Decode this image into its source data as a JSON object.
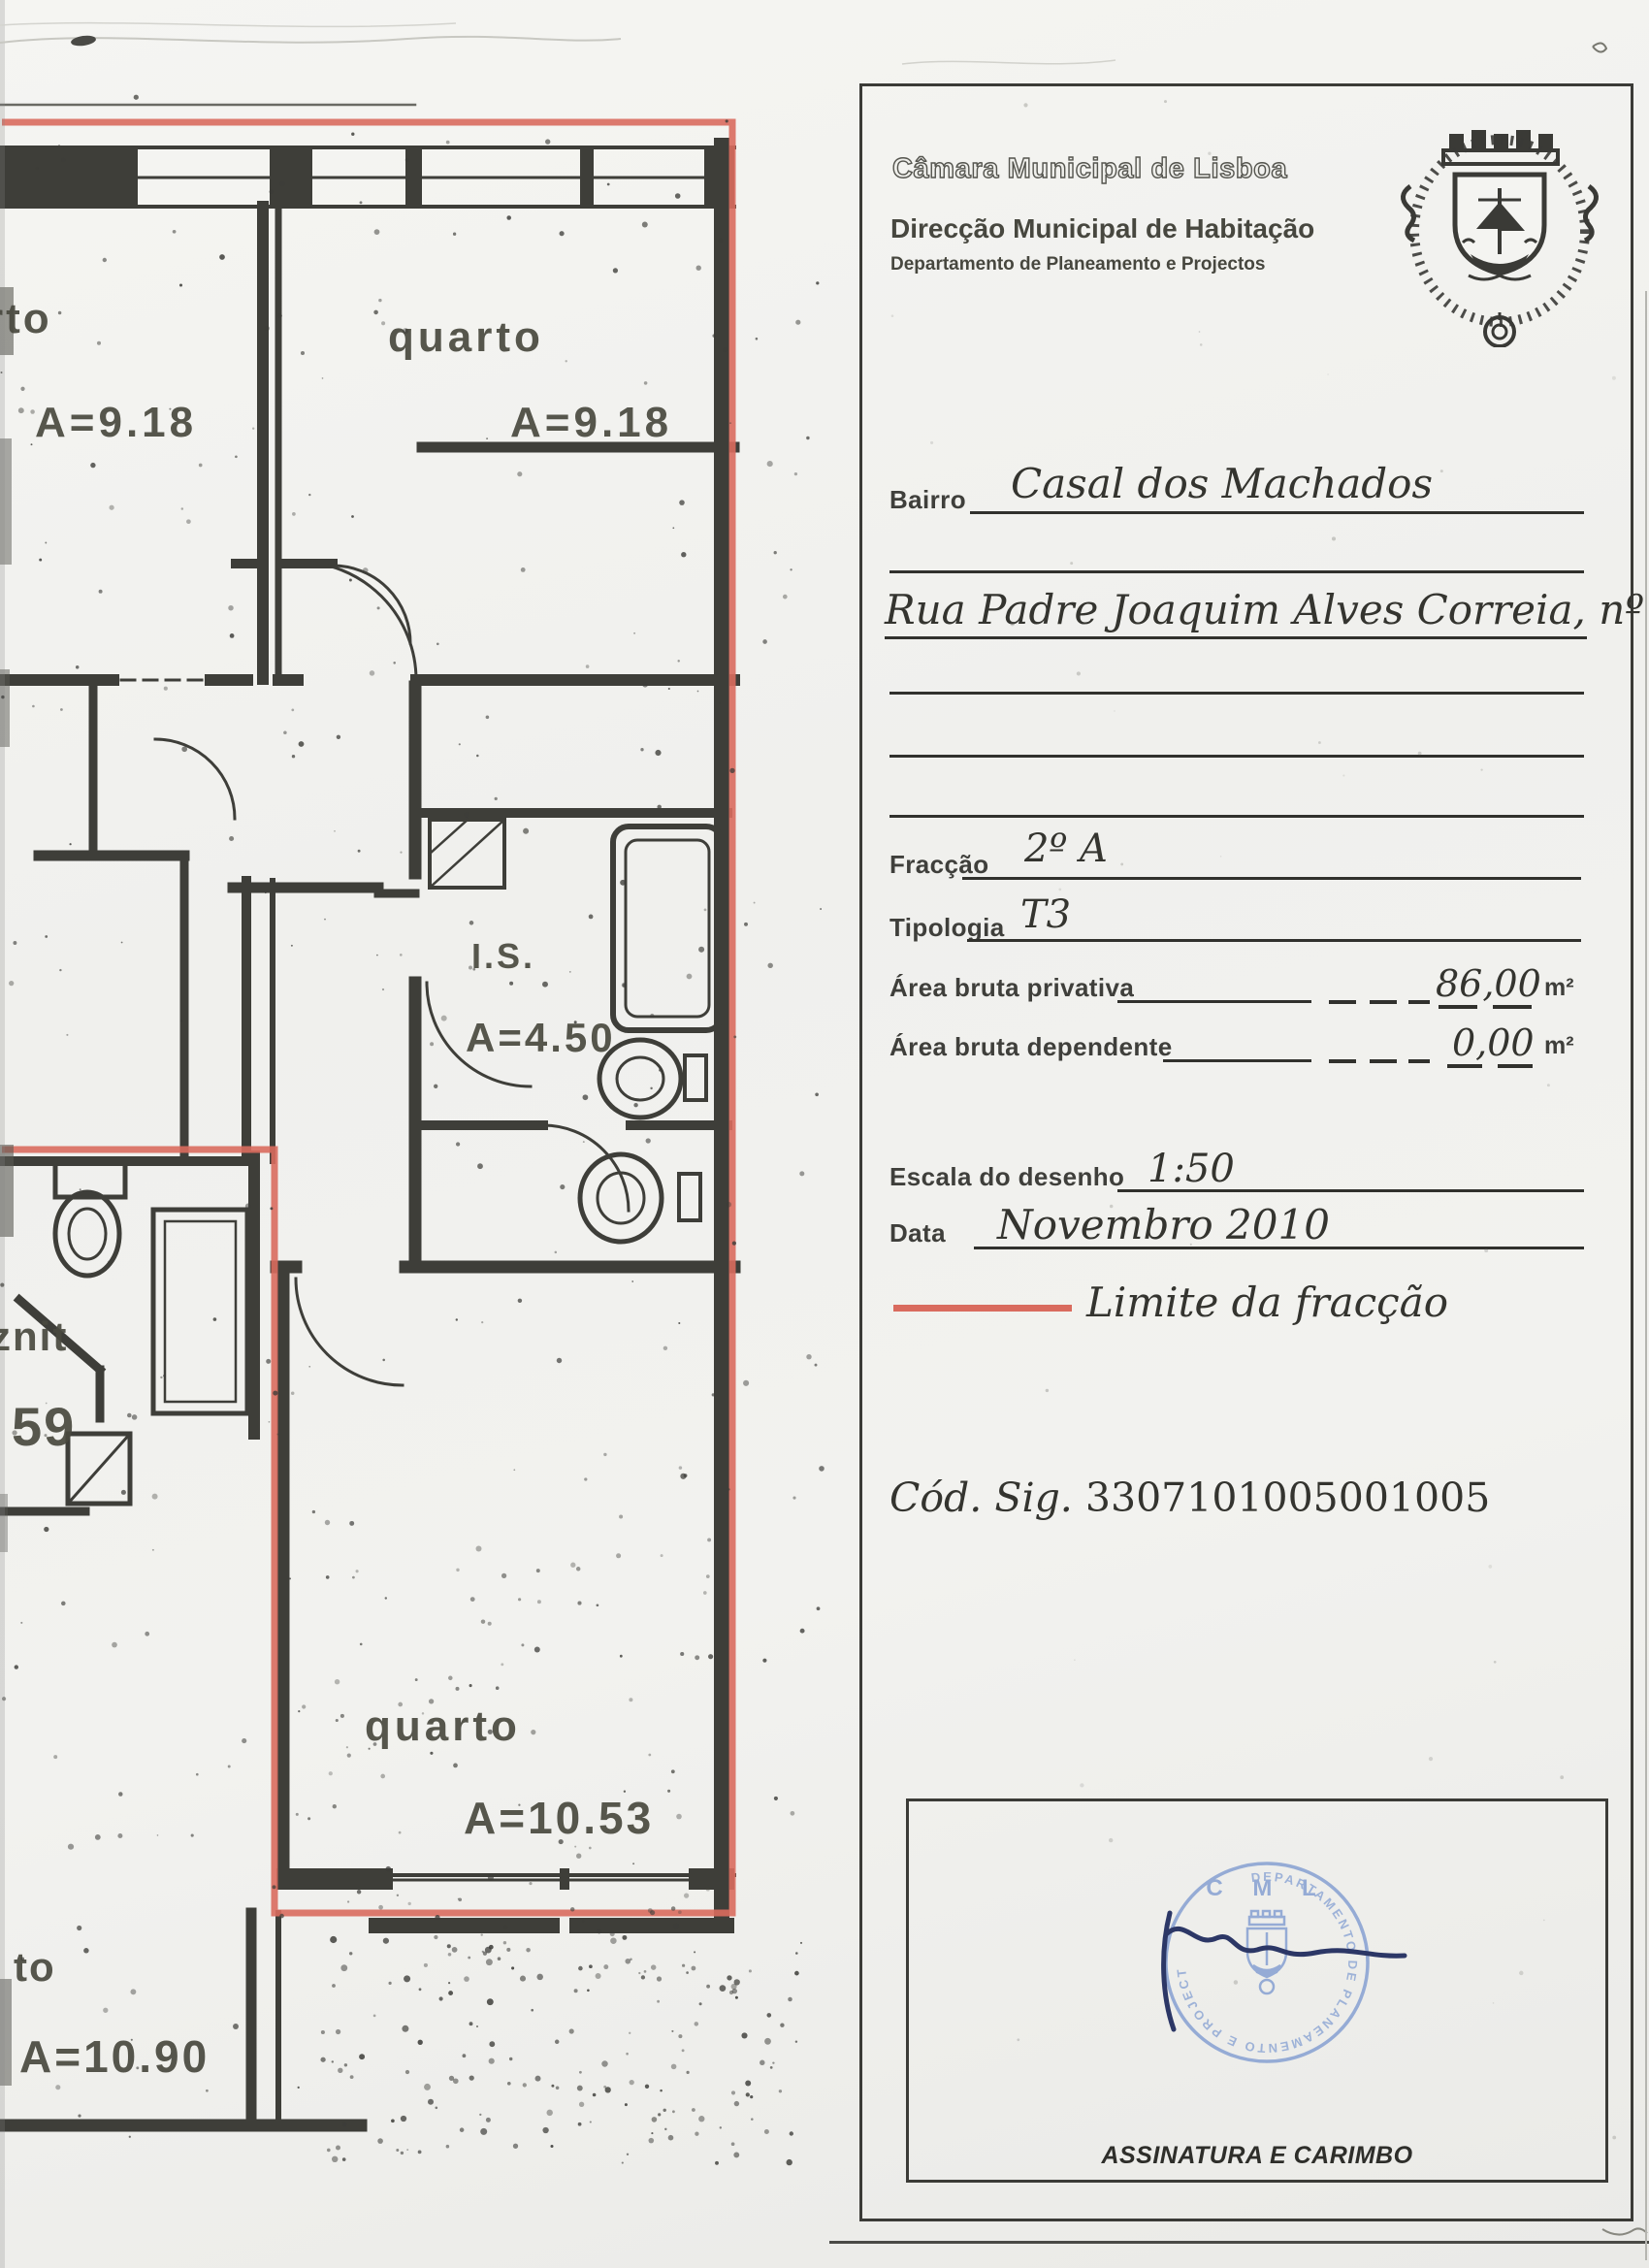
{
  "header": {
    "municipality": "Câmara Municipal de Lisboa",
    "directorate": "Direcção Municipal de Habitação",
    "department": "Departamento de Planeamento e Projectos",
    "crest_icon": "lisbon-municipal-coat-of-arms"
  },
  "form": {
    "bairro": {
      "label": "Bairro",
      "value": "Casal dos Machados"
    },
    "morada": {
      "value": "Rua Padre Joaquim Alves Correia, nº 6"
    },
    "fraccao": {
      "label": "Fracção",
      "value": "2º A"
    },
    "tipologia": {
      "label": "Tipologia",
      "value": "T3"
    },
    "area_bruta_privativa": {
      "label": "Área bruta privativa",
      "value": "86,00",
      "unit": "m²"
    },
    "area_bruta_dependente": {
      "label": "Área bruta dependente",
      "value": "0,00",
      "unit": "m²"
    },
    "escala": {
      "label": "Escala do desenho",
      "value": "1:50"
    },
    "data": {
      "label": "Data",
      "value": "Novembro 2010"
    },
    "legend": {
      "label": "Limite da fracção"
    },
    "cod_sig": {
      "label": "Cód. Sig.",
      "value": "3307101005001005"
    }
  },
  "signature_block": {
    "caption": "ASSINATURA E CARIMBO",
    "stamp": {
      "top_text": "C M L",
      "ring_text": "DEPARTAMENTO DE PLANEAMENTO E PROJECTOS"
    }
  },
  "floor_plan": {
    "scale": "1:50",
    "rooms": [
      {
        "id": "quarto-top-left",
        "label": "rto",
        "area": "A=9.18"
      },
      {
        "id": "quarto-top-center",
        "label": "quarto",
        "area": "A=9.18"
      },
      {
        "id": "instalacao-sanitaria",
        "label": "I.S.",
        "area": "A=4.50"
      },
      {
        "id": "compartimento-esquerda",
        "label": "znit",
        "area": "59"
      },
      {
        "id": "quarto-inferior",
        "label": "quarto",
        "area": "A=10.53"
      },
      {
        "id": "quarto-inferior-esquerda",
        "label": "to",
        "area": "A=10.90"
      }
    ]
  },
  "colors": {
    "fraction_boundary": "#d96b5e",
    "stamp_blue": "#86a0d2",
    "ink": "#3b3b37"
  }
}
